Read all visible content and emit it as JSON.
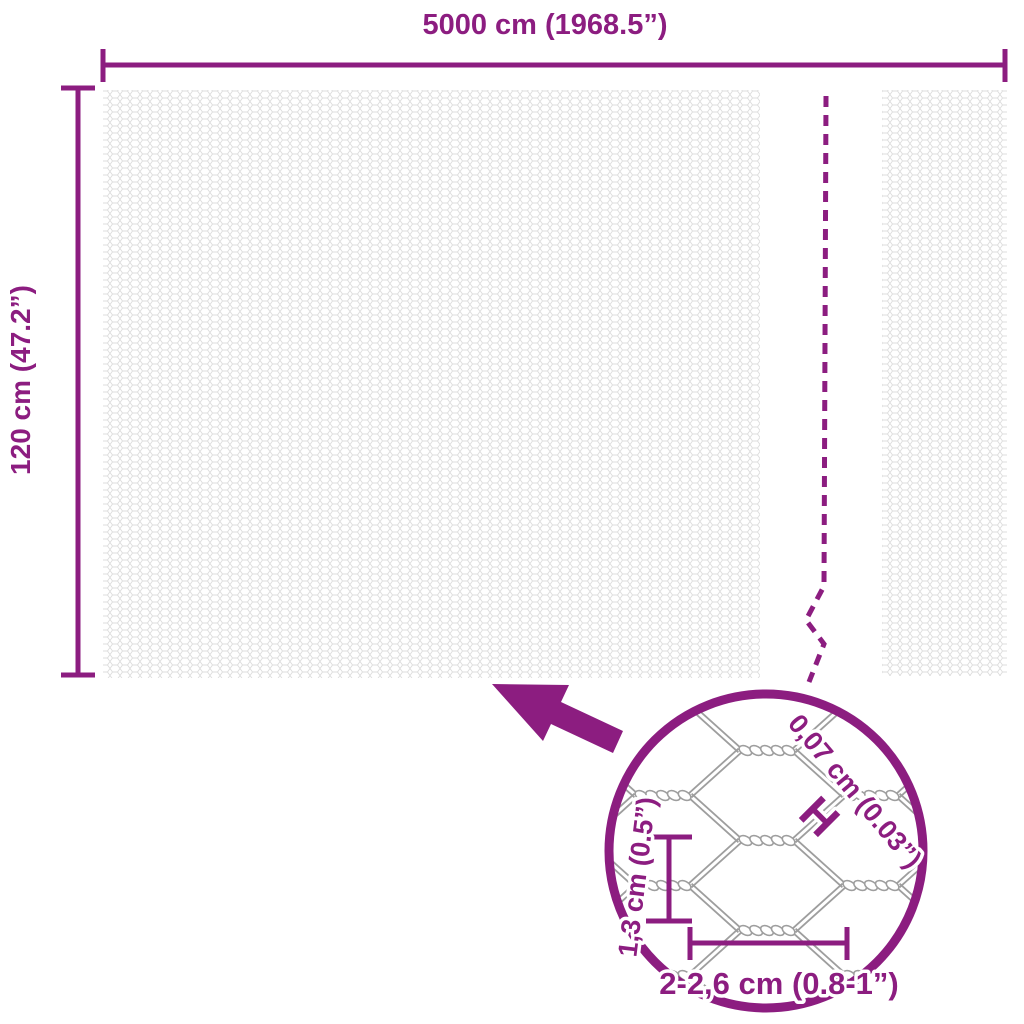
{
  "diagram_type": "product-dimension-diagram",
  "product": "hexagonal wire mesh fence roll",
  "colors": {
    "accent_purple": "#8c1d80",
    "mesh_texture_gray": "#dcdcdc",
    "detail_wire_gray": "#9e9e9e",
    "background": "#ffffff"
  },
  "dimensions": {
    "width": {
      "label": "5000 cm (1968.5”)"
    },
    "height": {
      "label": "120 cm (47.2”)"
    }
  },
  "detail_view": {
    "wire_thickness": {
      "label": "0,07 cm (0.03”)",
      "marker": "H"
    },
    "mesh_opening_height": {
      "label": "1,3 cm (0.5”)"
    },
    "mesh_opening_width": {
      "label": "2-2,6 cm (0.8-1”)"
    }
  },
  "icons": {
    "zoom_arrow": "arrow-from-detail-to-mesh",
    "magnifier_circle": "detail-zoom-circle",
    "break_line": "dashed-length-break-line"
  }
}
